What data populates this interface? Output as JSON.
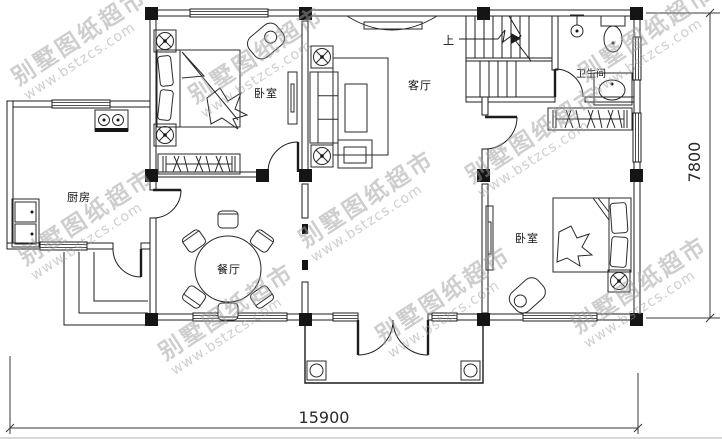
{
  "colors": {
    "line": "#1c1c1c",
    "dimension_text": "#2a2a2a",
    "watermark": "#9e9e9e",
    "background": "#ffffff"
  },
  "watermark": {
    "title": "别墅图纸超市",
    "url": "www.bstzcs.com"
  },
  "rooms": {
    "bedroom_left": "卧室",
    "living_room": "客厅",
    "bathroom": "卫生间",
    "kitchen": "厨房",
    "dining_room": "餐厅",
    "bedroom_right": "卧室"
  },
  "stairs": {
    "up_label": "上"
  },
  "dimensions": {
    "overall_width_mm": "15900",
    "overall_depth_mm": "7800"
  }
}
